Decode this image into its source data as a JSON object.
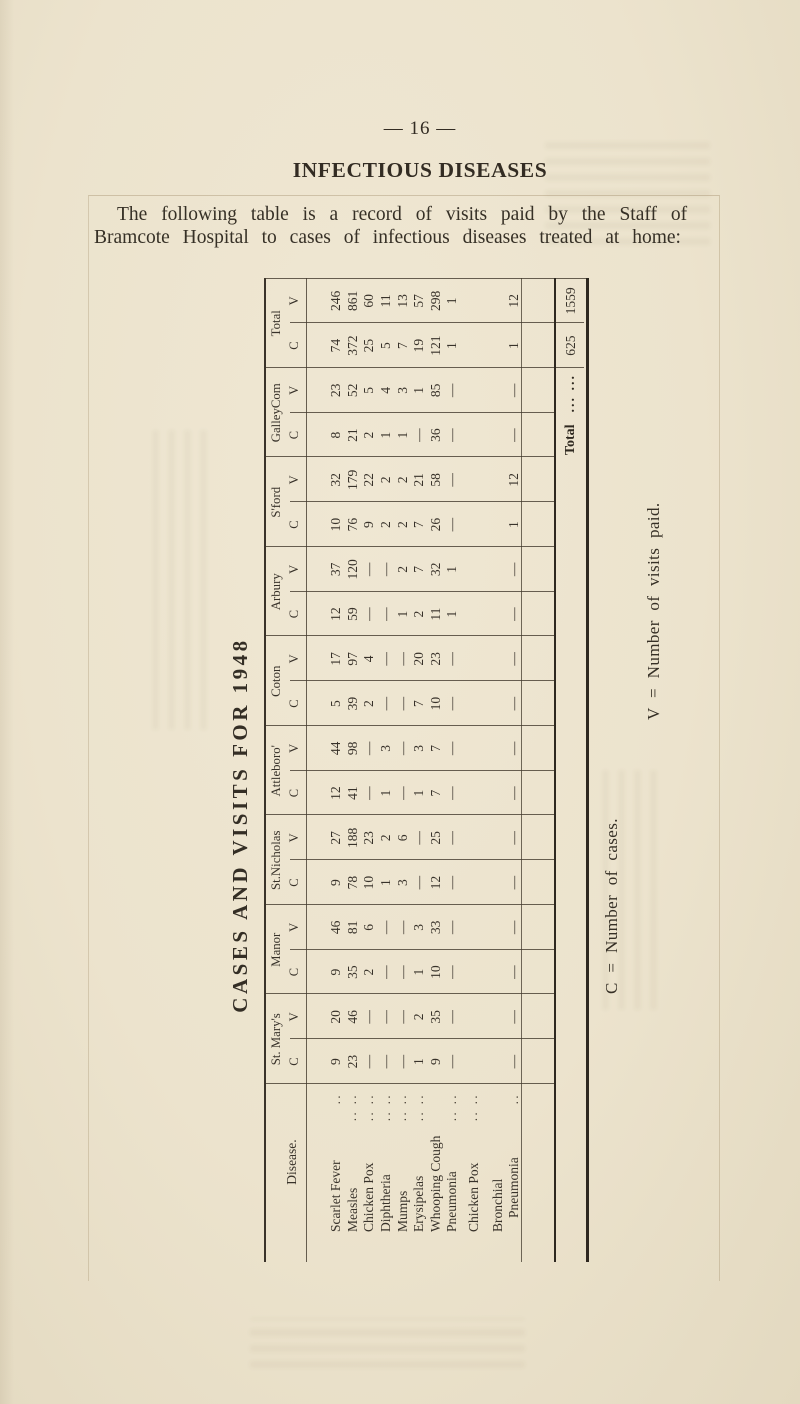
{
  "page": {
    "page_number": "— 16 —",
    "heading": "INFECTIOUS DISEASES",
    "intro_line1": "The following table is a record of visits paid by the Staff of",
    "intro_line2": "Bramcote Hospital to cases of infectious diseases treated at home:",
    "table_title": "CASES AND VISITS FOR 1948",
    "key_c": "C = Number of cases.",
    "key_v": "V = Number of visits paid."
  },
  "table": {
    "disease_header": "Disease.",
    "stations": [
      "St. Mary's",
      "Manor",
      "St.Nicholas",
      "Attleboro'",
      "Coton",
      "Arbury",
      "S'ford",
      "GalleyCom",
      "Total"
    ],
    "subheaders": [
      "C",
      "V"
    ],
    "rows": [
      {
        "disease": "Scarlet Fever",
        "dots": "..",
        "values": [
          [
            "9",
            "20"
          ],
          [
            "9",
            "46"
          ],
          [
            "9",
            "27"
          ],
          [
            "12",
            "44"
          ],
          [
            "5",
            "17"
          ],
          [
            "12",
            "37"
          ],
          [
            "10",
            "32"
          ],
          [
            "8",
            "23"
          ],
          [
            "74",
            "246"
          ]
        ]
      },
      {
        "disease": "Measles",
        "dots": ".. ..",
        "values": [
          [
            "23",
            "46"
          ],
          [
            "35",
            "81"
          ],
          [
            "78",
            "188"
          ],
          [
            "41",
            "98"
          ],
          [
            "39",
            "97"
          ],
          [
            "59",
            "120"
          ],
          [
            "76",
            "179"
          ],
          [
            "21",
            "52"
          ],
          [
            "372",
            "861"
          ]
        ]
      },
      {
        "disease": "Chicken Pox",
        "dots": ".. ..",
        "values": [
          [
            "—",
            "—"
          ],
          [
            "2",
            "6"
          ],
          [
            "10",
            "23"
          ],
          [
            "—",
            "—"
          ],
          [
            "2",
            "4"
          ],
          [
            "—",
            "—"
          ],
          [
            "9",
            "22"
          ],
          [
            "2",
            "5"
          ],
          [
            "25",
            "60"
          ]
        ]
      },
      {
        "disease": "Diphtheria",
        "dots": ".. ..",
        "values": [
          [
            "—",
            "—"
          ],
          [
            "—",
            "—"
          ],
          [
            "1",
            "2"
          ],
          [
            "1",
            "3"
          ],
          [
            "—",
            "—"
          ],
          [
            "—",
            "—"
          ],
          [
            "2",
            "2"
          ],
          [
            "1",
            "4"
          ],
          [
            "5",
            "11"
          ]
        ]
      },
      {
        "disease": "Mumps",
        "dots": ".. ..",
        "values": [
          [
            "—",
            "—"
          ],
          [
            "—",
            "—"
          ],
          [
            "3",
            "6"
          ],
          [
            "—",
            "—"
          ],
          [
            "—",
            "—"
          ],
          [
            "1",
            "2"
          ],
          [
            "2",
            "2"
          ],
          [
            "1",
            "3"
          ],
          [
            "7",
            "13"
          ]
        ]
      },
      {
        "disease": "Erysipelas",
        "dots": ".. ..",
        "values": [
          [
            "1",
            "2"
          ],
          [
            "1",
            "3"
          ],
          [
            "—",
            "—"
          ],
          [
            "1",
            "3"
          ],
          [
            "7",
            "20"
          ],
          [
            "2",
            "7"
          ],
          [
            "7",
            "21"
          ],
          [
            "—",
            "1"
          ],
          [
            "19",
            "57"
          ]
        ]
      },
      {
        "disease": "Whooping Cough",
        "dots": "",
        "values": [
          [
            "9",
            "35"
          ],
          [
            "10",
            "33"
          ],
          [
            "12",
            "25"
          ],
          [
            "7",
            "7"
          ],
          [
            "10",
            "23"
          ],
          [
            "11",
            "32"
          ],
          [
            "26",
            "58"
          ],
          [
            "36",
            "85"
          ],
          [
            "121",
            "298"
          ]
        ]
      },
      {
        "disease": "Pneumonia",
        "dots": ".. ..",
        "values": [
          [
            "—",
            "—"
          ],
          [
            "—",
            "—"
          ],
          [
            "—",
            "—"
          ],
          [
            "—",
            "—"
          ],
          [
            "—",
            "—"
          ],
          [
            "1",
            "1"
          ],
          [
            "—",
            "—"
          ],
          [
            "—",
            "—"
          ],
          [
            "1",
            "1"
          ]
        ]
      },
      {
        "disease": "Chicken Pox",
        "dots": ".. ..",
        "values": [
          [
            "",
            ""
          ],
          [
            "",
            ""
          ],
          [
            "",
            ""
          ],
          [
            "",
            ""
          ],
          [
            "",
            ""
          ],
          [
            "",
            ""
          ],
          [
            "",
            ""
          ],
          [
            "",
            ""
          ],
          [
            "",
            ""
          ]
        ]
      },
      {
        "disease": "Bronchial",
        "disease_line2": "Pneumonia",
        "dots": "..",
        "values": [
          [
            "—",
            "—"
          ],
          [
            "—",
            "—"
          ],
          [
            "—",
            "—"
          ],
          [
            "—",
            "—"
          ],
          [
            "—",
            "—"
          ],
          [
            "—",
            "—"
          ],
          [
            "1",
            "12"
          ],
          [
            "—",
            "—"
          ],
          [
            "1",
            "12"
          ]
        ]
      }
    ],
    "total_row": {
      "label": "Total",
      "dots": "...  ...",
      "c": "625",
      "v": "1559"
    }
  }
}
